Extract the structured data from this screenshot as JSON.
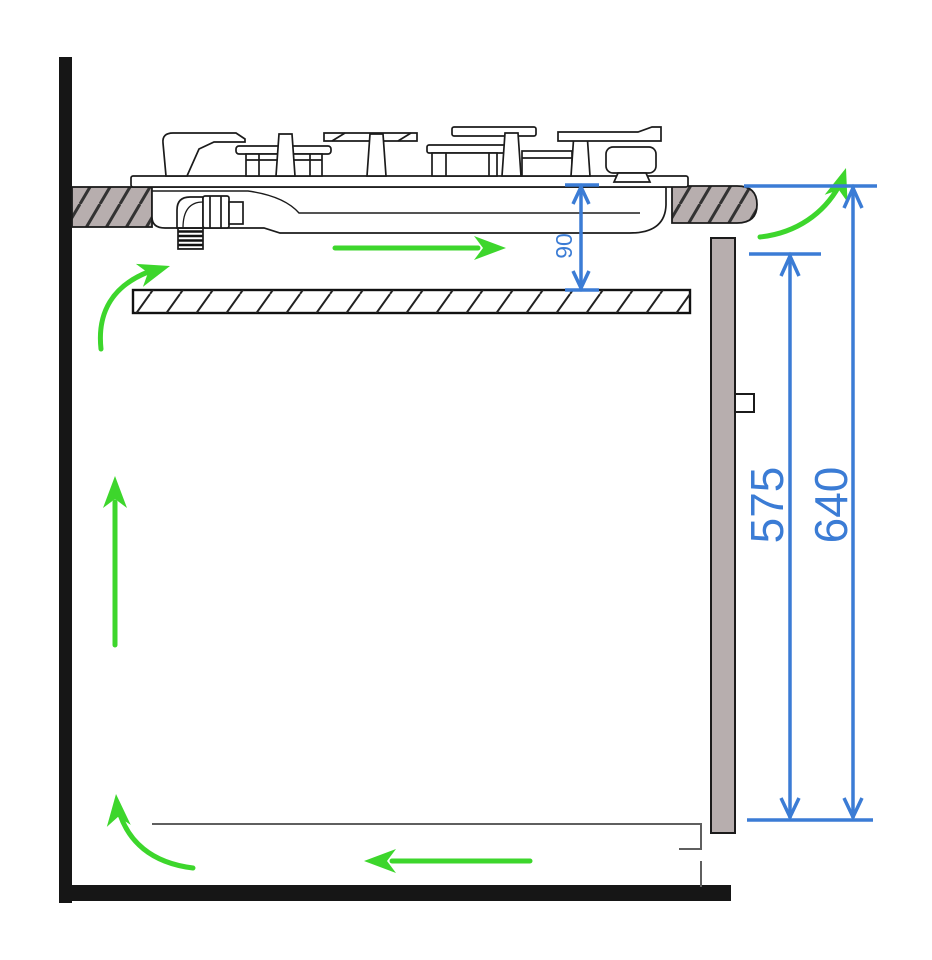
{
  "diagram": {
    "dimension_labels": {
      "hob_to_shelf_gap_mm": "90",
      "rear_panel_height_mm": "575",
      "worktop_to_base_height_mm": "640"
    },
    "colors": {
      "dimension_blue": "#3b7cd5",
      "airflow_green": "#3dd62c",
      "surface_taupe": "#b7aeae",
      "structure_black": "#161616"
    }
  }
}
